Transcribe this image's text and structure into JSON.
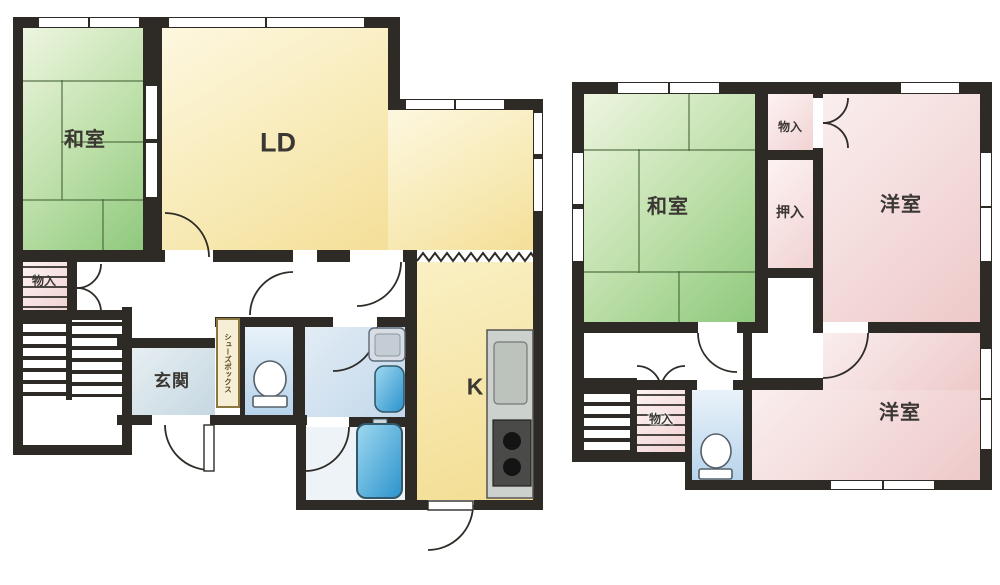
{
  "plan": {
    "floor1": {
      "washitsu_label": "和室",
      "ld_label": "LD",
      "storage_label": "物入",
      "genkan_label": "玄関",
      "kitchen_label": "K",
      "shoebox_label": "シューズボックス"
    },
    "floor2": {
      "washitsu_label": "和室",
      "storage_top_label": "物入",
      "oshiire_label": "押入",
      "western_upper_label": "洋室",
      "western_lower_label": "洋室",
      "storage_bottom_label": "物入"
    },
    "colors": {
      "wall": "#2e2b26",
      "tatami_green": "#9ed18c",
      "flooring_yellow": "#f6e5a4",
      "western_pink": "#f0cfcf",
      "water_blue": "#c3d9ec",
      "fixture_blue": "#35a0d8"
    }
  }
}
